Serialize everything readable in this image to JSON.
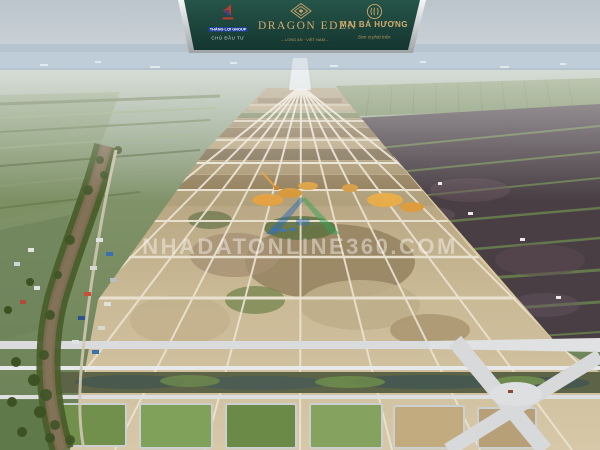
{
  "banner": {
    "background_color": "#1d473c",
    "edge_color": "#c8ccce",
    "gold_color": "#cfa96b",
    "developer": {
      "logo_icon": "sailboat-icon",
      "name": "THẮNG LỢI GROUP",
      "role": "CHỦ ĐẦU TƯ"
    },
    "project": {
      "logo_icon": "lotus-diamond-icon",
      "name": "DRAGON EDEN",
      "tagline": "– LONG AN · VIỆT NAM –"
    },
    "partner": {
      "logo_icon": "monogram-ring-icon",
      "name": "MAI BÁ HƯƠNG",
      "tagline": "Đơn vị phát triển"
    }
  },
  "watermark": {
    "logo_icon": "house-roof-icon",
    "text": "NHADATONLINE360.COM",
    "text_color": "#ffffff",
    "text_opacity": 0.42,
    "roof_left_color": "#2e6db6",
    "roof_right_color": "#35a356"
  },
  "scene": {
    "description": "Aerial drone photo of a large land-subdivision construction site: grid of cleared plots and new roads in the center, winding canal with trees and houses on the left, flooded rice paddies on the right, hazy horizon with distant city",
    "colors": {
      "sky_haze": "#c9d3d9",
      "distant_city": "#b2c2ce",
      "farmland_green": "#74885c",
      "cleared_land": "#c2b08c",
      "river_water": "#7b6b51",
      "paddy_water": "#4a4046",
      "paved_road": "#d8dadb",
      "sand_pile": "#e3a243",
      "grass_block": "#71904c"
    }
  }
}
